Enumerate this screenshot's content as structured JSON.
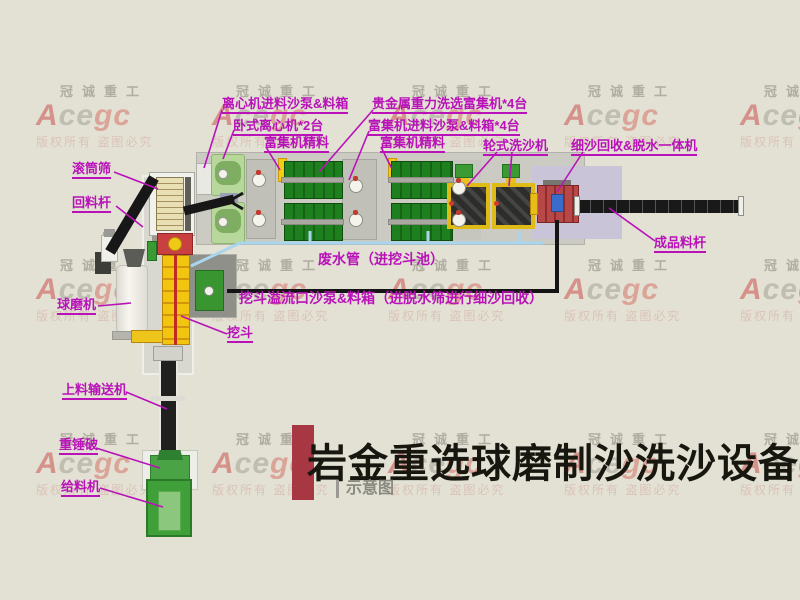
{
  "watermark": {
    "company": "冠诚重工",
    "logo_a": "A",
    "logo_ce": "ce",
    "logo_gc": "gc",
    "notice": "版权所有 盗图必究"
  },
  "labels": [
    {
      "text": "离心机进料沙泵&料箱"
    },
    {
      "text": "卧式离心机*2台"
    },
    {
      "text": "富集机精料"
    },
    {
      "text": "贵金属重力洗选富集机*4台"
    },
    {
      "text": "富集机进料沙泵&料箱*4台"
    },
    {
      "text": "富集机精料"
    },
    {
      "text": "轮式洗沙机"
    },
    {
      "text": "细沙回收&脱水一体机"
    },
    {
      "text": "滚筒筛"
    },
    {
      "text": "回料杆"
    },
    {
      "text": "球磨机"
    },
    {
      "text": "挖斗"
    },
    {
      "text": "上料输送机"
    },
    {
      "text": "重锤破"
    },
    {
      "text": "给料机"
    },
    {
      "text": "废水管（进挖斗池）"
    },
    {
      "text": "挖斗溢流口沙泵&料箱（进脱水筛进行细沙回收）"
    },
    {
      "text": "成品料杆"
    }
  ],
  "title": {
    "text": "岩金重选球磨制沙洗沙设备",
    "subtitle": "示意图"
  },
  "colors": {
    "label_magenta": "#b812b8",
    "title_bar_red": "#a83744",
    "watermark_red": "#c53030",
    "background": "#e2e1d4",
    "pipe_blue": "#a9d6ee"
  }
}
